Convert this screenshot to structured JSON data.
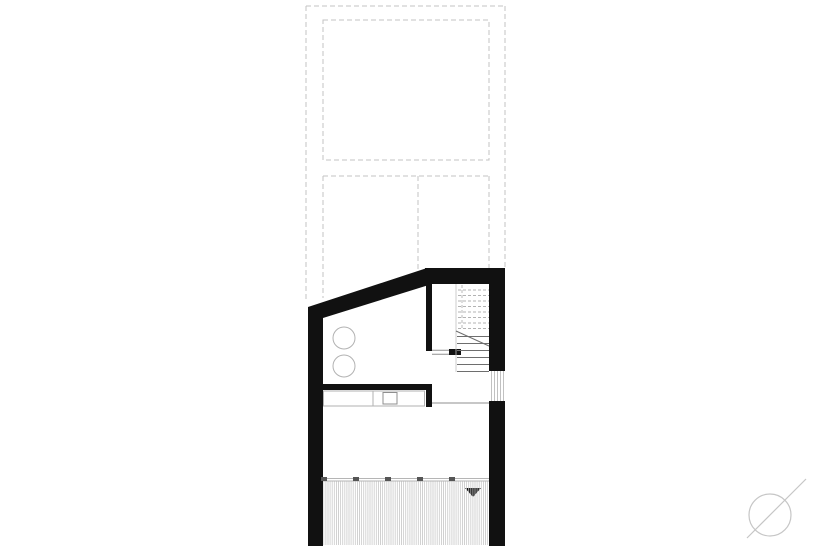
{
  "drawing": {
    "kind_label": "floor-plan",
    "visible_text": []
  },
  "colors": {
    "background": "#ffffff",
    "wall": "#111111",
    "projection": "#c3c3c3",
    "fixture": "#b2b2b2",
    "detail": "#8f8f8f",
    "stair_upper": "#b3b3b3",
    "stair_lower": "#6e6e6e",
    "stair_edge": "#c0c0c0",
    "deck_stripe": "#c9c9c9",
    "deck_edge": "#b5b5b5",
    "deck_tick": "#555555",
    "arrow": "#111111",
    "north": "#c6c6c6"
  }
}
